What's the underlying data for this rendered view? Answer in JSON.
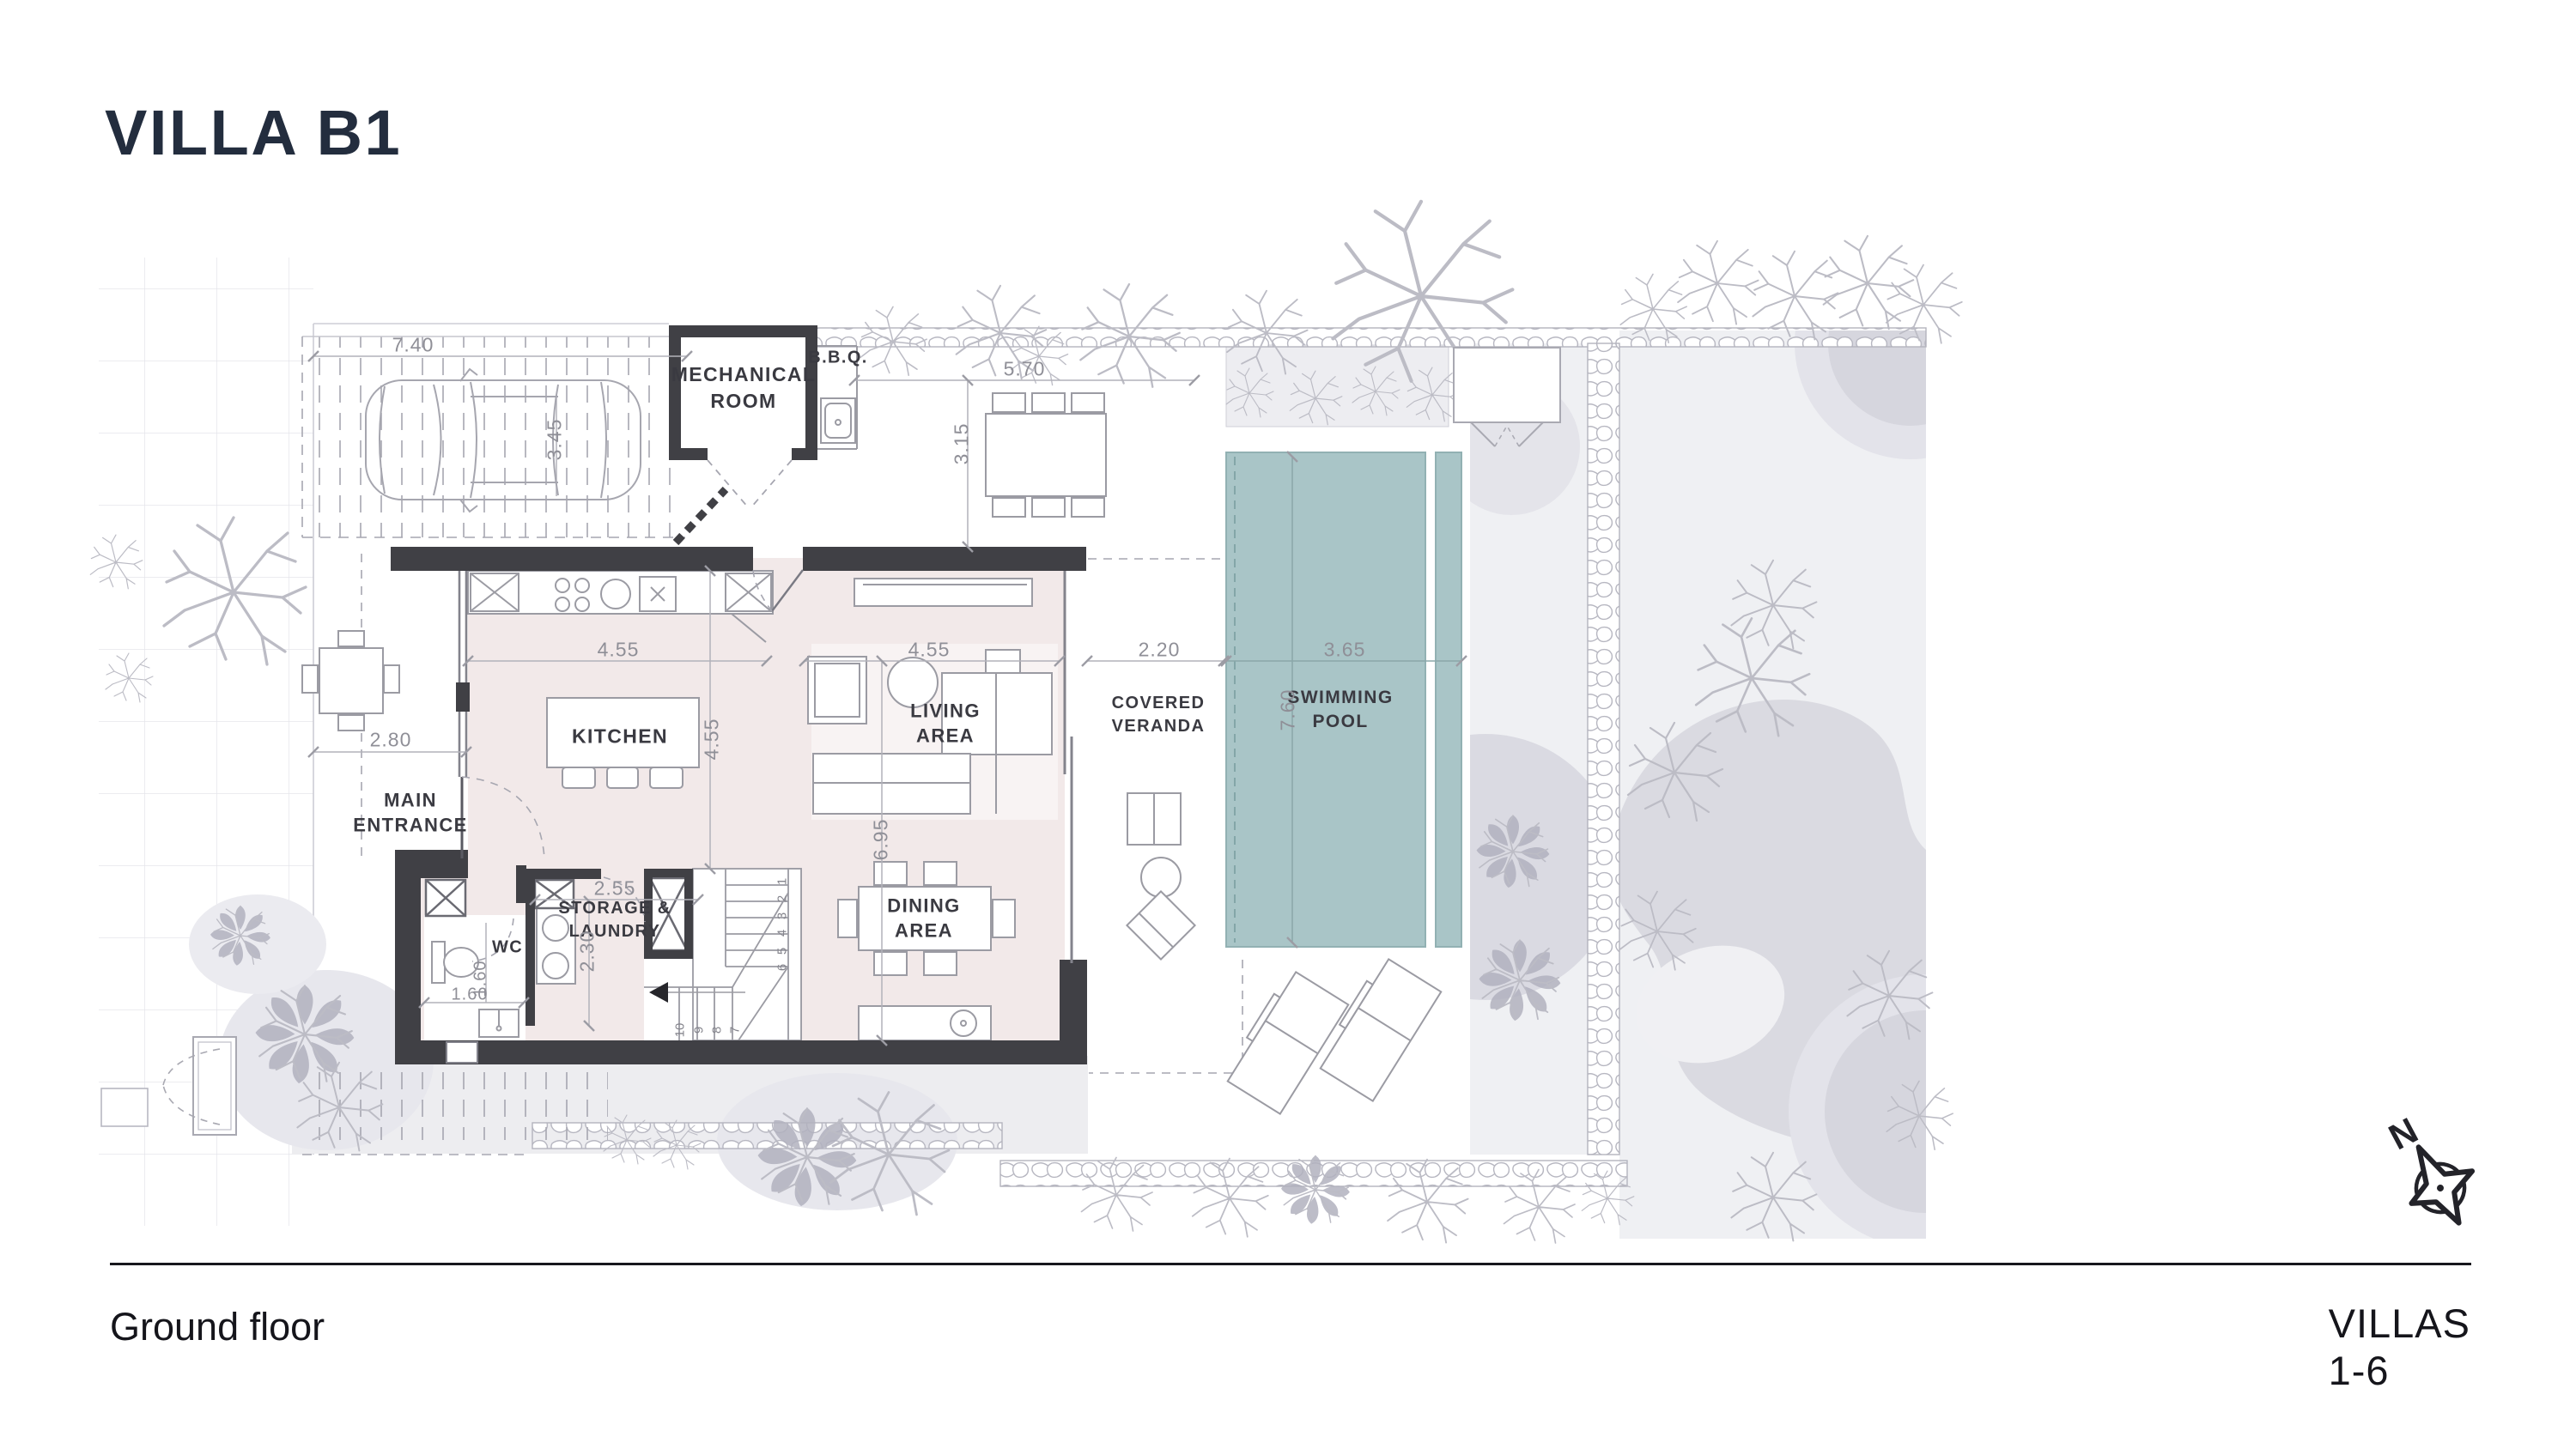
{
  "title": "VILLA B1",
  "footer": {
    "left": "Ground floor",
    "right": "VILLAS 1-6",
    "compass_letter": "N"
  },
  "colors": {
    "accent_navy": "#232d3e",
    "wall_dark": "#404045",
    "floor_pink": "#f2e9e9",
    "pool_teal": "#a9c5c7",
    "landscape_gray": "#eff0f3",
    "blob_gray": "#dadae2",
    "dim_gray": "#8f8f97"
  },
  "plan": {
    "rooms": [
      {
        "label": "MECHANICAL\nROOM"
      },
      {
        "label": "B.B.Q."
      },
      {
        "label": "KITCHEN"
      },
      {
        "label": "LIVING\nAREA"
      },
      {
        "label": "DINING\nAREA"
      },
      {
        "label": "STORAGE &\nLAUNDRY"
      },
      {
        "label": "WC"
      },
      {
        "label": "MAIN\nENTRANCE"
      },
      {
        "label": "COVERED\nVERANDA"
      },
      {
        "label": "SWIMMING\nPOOL"
      }
    ],
    "dims": [
      {
        "text": "7.40"
      },
      {
        "text": "3.45"
      },
      {
        "text": "5.70"
      },
      {
        "text": "3.15"
      },
      {
        "text": "4.55"
      },
      {
        "text": "4.55"
      },
      {
        "text": "4.55"
      },
      {
        "text": "6.95"
      },
      {
        "text": "2.80"
      },
      {
        "text": "2.55"
      },
      {
        "text": "2.30"
      },
      {
        "text": "1.60"
      },
      {
        "text": "1.60"
      },
      {
        "text": "2.20"
      },
      {
        "text": "3.65"
      },
      {
        "text": "7.60"
      }
    ],
    "stair_numbers": [
      "1",
      "2",
      "3",
      "4",
      "5",
      "6",
      "7",
      "8",
      "9",
      "10"
    ]
  }
}
